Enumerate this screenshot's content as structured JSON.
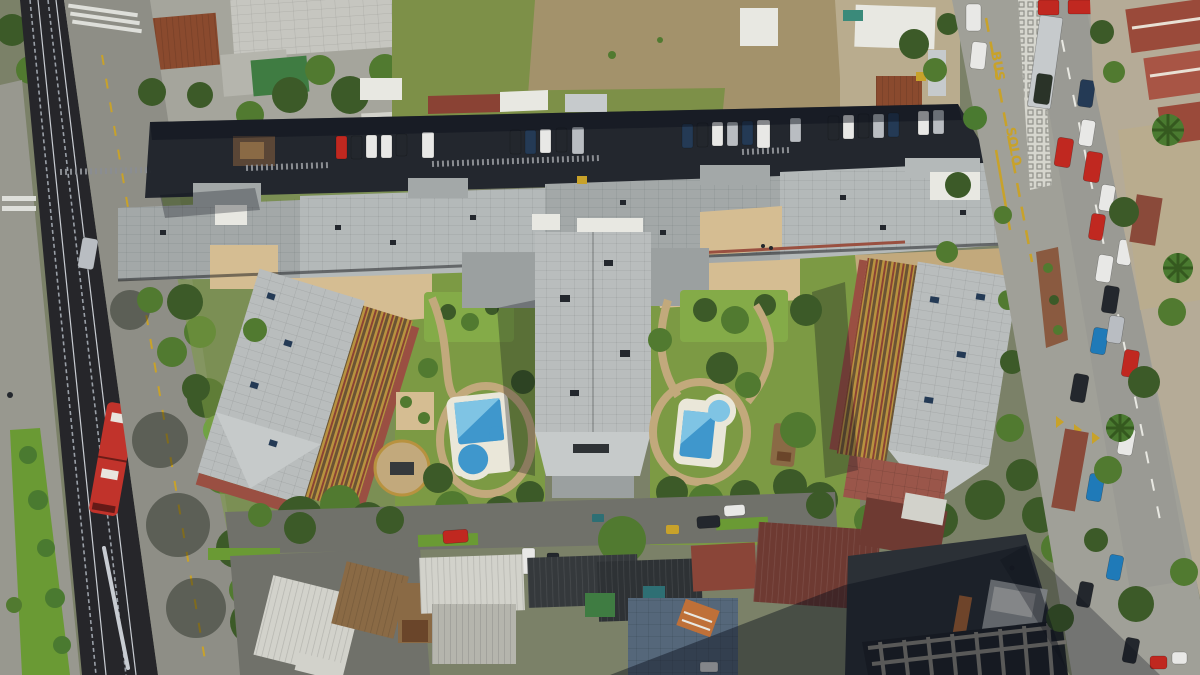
{
  "scene": {
    "type": "aerial-drone-photograph",
    "description": "Top-down drone view of a large apartment complex with three mid-rise residential towers joined by a long roof strip, two swimming pools in landscaped gardens, a shaded parking lot, an elevated rail corridor with a red metro train on the left, a vacant dirt lot at top, a busy avenue with a bus lane on the right, and rows of small house rooftops along the bottom.",
    "road_markings": {
      "bus_lane_word_1": "BUS",
      "bus_lane_word_2": "SOLO"
    },
    "counts": {
      "residential_towers": 3,
      "swimming_pools": 2,
      "kiddie_pools": 2,
      "rail_tracks": 4,
      "red_trucks": 2
    }
  },
  "palette": {
    "base": "#7b8168",
    "asphalt": "#8e8e86",
    "asphaltLight": "#a0a098",
    "asphaltShade": "#70716a",
    "roadWest": "#98988f",
    "railDark": "#26262a",
    "railLine": "#9aa0a8",
    "railGlint": "#c8ccd2",
    "trainRed": "#c1332b",
    "trainDetail": "#e8e4de",
    "laneYellow": "#c8a22a",
    "laneWhite": "#e8e8e2",
    "crosswalkWhite": "#dedfda",
    "dirtLot": "#a3926b",
    "dirtPale": "#b9ac8e",
    "dirtPath": "#c2a97c",
    "grassField": "#7d9048",
    "lawn": "#7c9a44",
    "lawnBright": "#84ab48",
    "treeDark": "#3c5a28",
    "treeMid": "#517a30",
    "treeLight": "#6fa344",
    "hedge": "#6a9a34",
    "palm": "#4a7a30",
    "parking": "#23272e",
    "stallLine": "#8a8d92",
    "roofStrip": "#a3a8a8",
    "roofStripLight": "#b4b9b9",
    "roofTower": "#b9bdbd",
    "roofHip": "#c6caca",
    "roofWhite": "#e8e8e2",
    "roofLowGray": "#9ba0a0",
    "terraceTan": "#d5bd92",
    "walkRed": "#9a5040",
    "facadeGold": "#b8923f",
    "facadeDark": "#6b5334",
    "facadeRed": "#8a4234",
    "baseRed": "#9a4f42",
    "terraceBrick": "#9a564a",
    "poolDeck": "#eae7d9",
    "poolWater": "#3f97cc",
    "poolWaterLight": "#7fc4e4",
    "kioskBrown": "#5a4636",
    "carRed": "#c02820",
    "carWhite": "#e8e8e6",
    "carSilver": "#b9bdc2",
    "carDark": "#23272d",
    "carNavy": "#243a55",
    "carBlue": "#1f7ab8",
    "carGreen": "#2a3328",
    "truckTrailer": "#c6cacc",
    "medianWhite": "#d6d6ce",
    "medianGray": "#9a9a94",
    "planterBrown": "#8a5a40",
    "sidewalk": "#b5ab97",
    "wallBrick": "#8a4a3a",
    "roofTerracotta": "#9a4a3a",
    "roofTerracotta2": "#a85545",
    "roofRust": "#8a4a2e",
    "roofRust2": "#9a5535",
    "plazaGray": "#a5a59c",
    "bigRoofGray": "#c6c6c0",
    "roofWhiteHouse": "#d2d2cb",
    "roofGrayHouse": "#b5b5ad",
    "woodDeck": "#8a6a45",
    "woodDark": "#6a452a",
    "roofCharcoal": "#35393c",
    "roofCharcoal2": "#2e3235",
    "shedGreen": "#3f7c42",
    "shedTeal": "#2e6f74",
    "roofMaroon": "#6e3a32",
    "roofMaroon2": "#8a4538",
    "blueGray": "#55677a",
    "blueGrayLight": "#7a8a9a",
    "orangeAccent": "#bf7038",
    "concreteDark": "#2b3036",
    "concreteFrame": "#9a958a",
    "concreteLight": "#a9aeae",
    "tarpBlue": "#3a6ea8",
    "tarpTeal": "#3a8a7a",
    "shadow": "rgba(12,16,26,0.45)",
    "shadowSoft": "rgba(12,16,26,0.30)",
    "canopyShadow": "rgba(18,24,14,0.40)"
  }
}
